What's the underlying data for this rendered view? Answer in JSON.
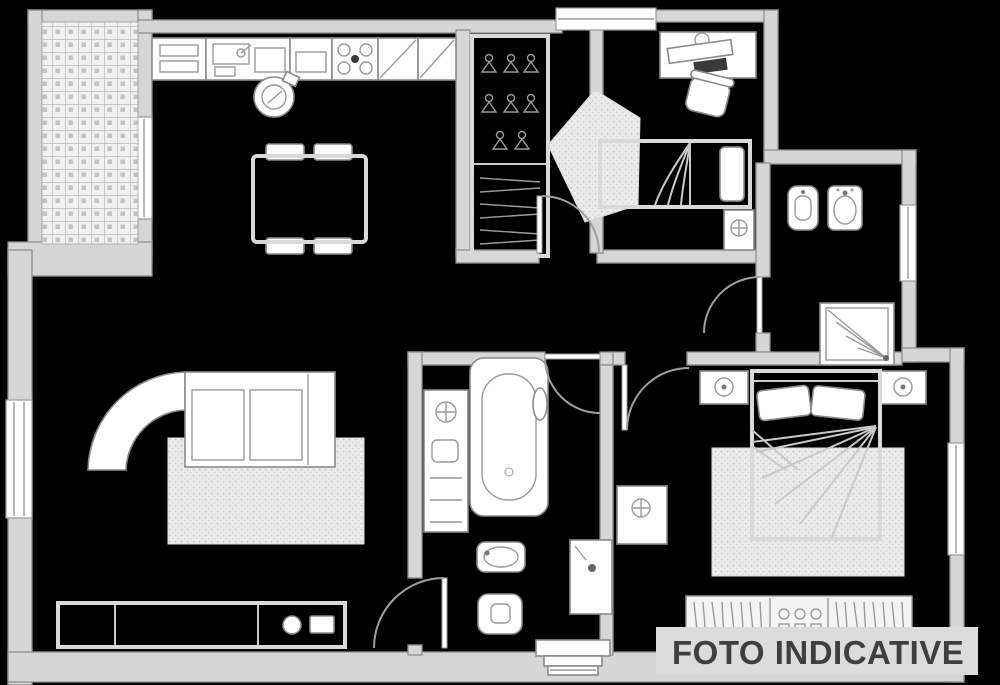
{
  "watermark": {
    "label": "FOTO INDICATIVE"
  },
  "palette": {
    "background": "#000000",
    "wall_fill": "#d6d6d6",
    "wall_stroke": "#8f8f8f",
    "furniture_fill": "#ffffff",
    "furniture_stroke": "#8a8a8a",
    "texture_fill": "#ececec",
    "texture_dot": "#c9c9c9",
    "tile_fill": "#f1f1f1",
    "tile_line": "#b8b8b8",
    "banner_bg": "#dcdcdc",
    "banner_text": "#3f3f3f",
    "dark_accent": "#3a3a3a"
  },
  "icons": [
    "terrace-tiles",
    "kitchen-counter",
    "kitchen-sink",
    "kitchen-stove-burners",
    "kitchen-cabinet-diagonal",
    "kitchen-stool",
    "dining-table",
    "dining-chair",
    "corner-sofa",
    "living-rug",
    "tv-sideboard",
    "closet-hangers",
    "closet-shelves",
    "entry-rug",
    "door-swing",
    "desk",
    "desk-chair",
    "single-bed",
    "flower-nightstand",
    "bidet",
    "washbasin",
    "shower",
    "window",
    "bathtub",
    "bathroom-cabinet",
    "toilet",
    "washing-machine",
    "double-bed",
    "pillow",
    "lamp-nightstand",
    "bedroom-rug",
    "wardrobe",
    "entrance-steps"
  ]
}
